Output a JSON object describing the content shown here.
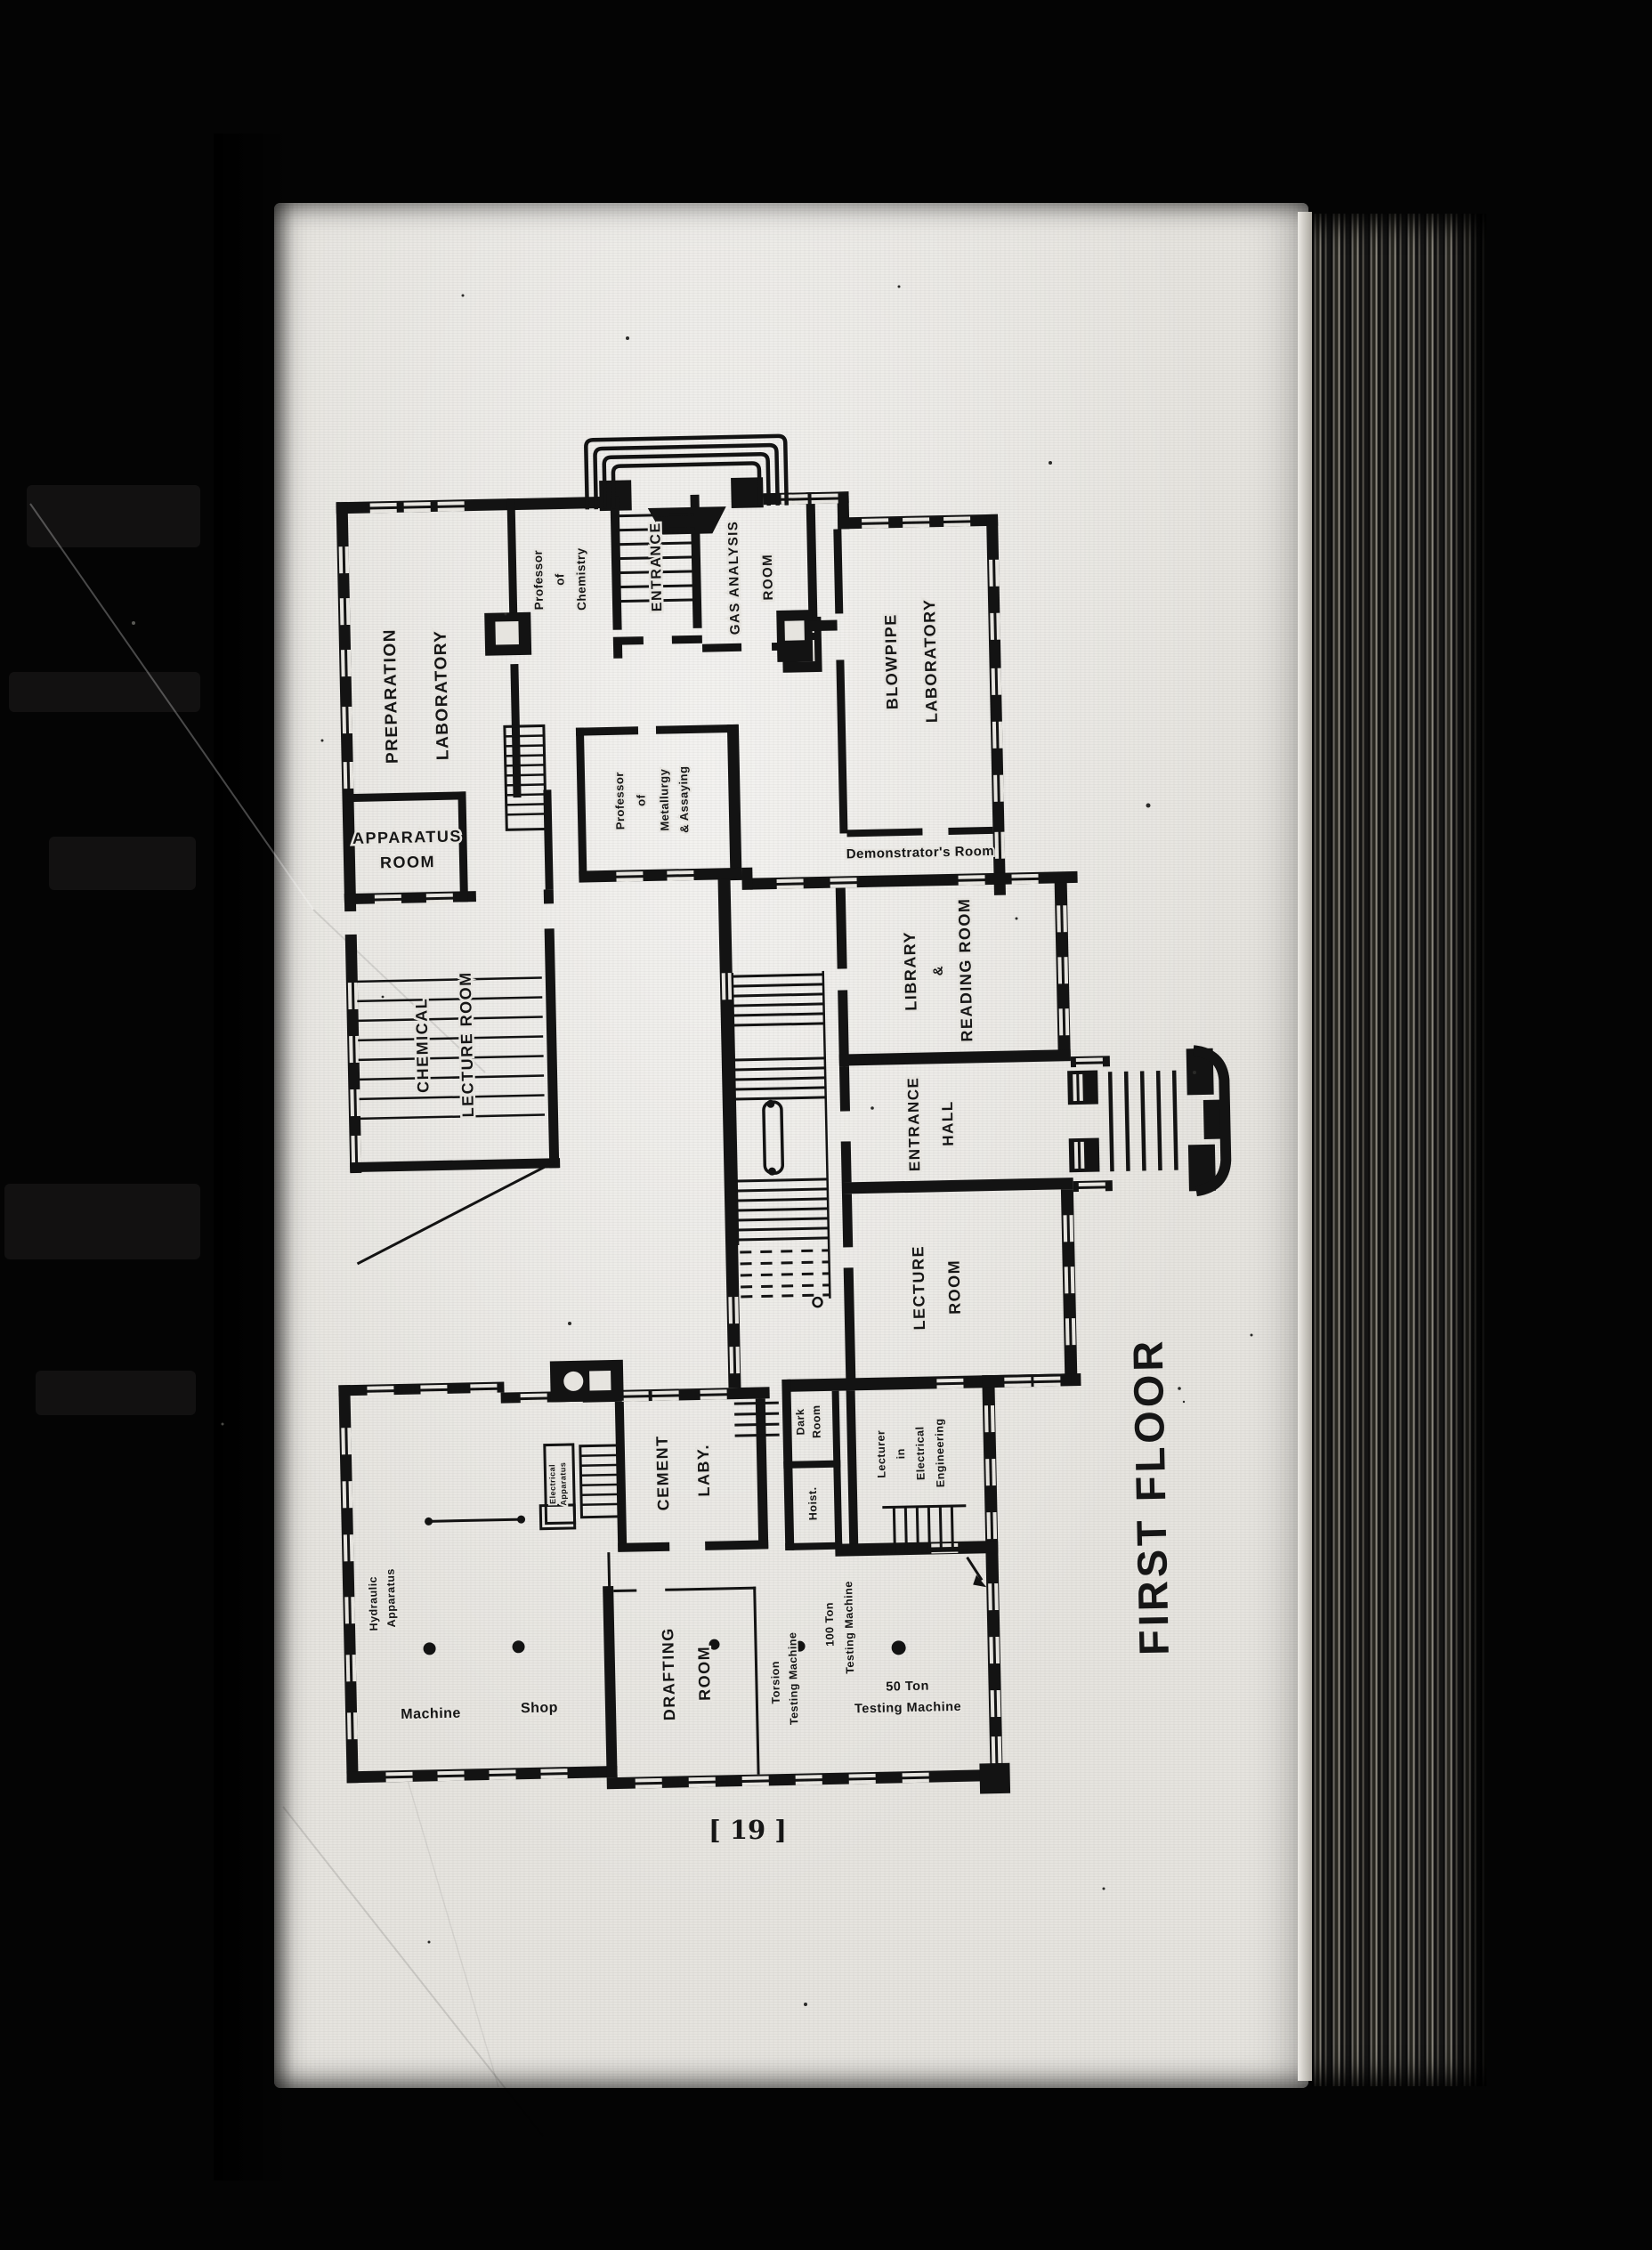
{
  "page": {
    "number": "[ 19 ]",
    "title": "FIRST FLOOR"
  },
  "colors": {
    "paper": "#e6e4df",
    "ink": "#131313",
    "background": "#040404"
  },
  "plan": {
    "rooms": {
      "preparation_laboratory": {
        "line1": "PREPARATION",
        "line2": "LABORATORY"
      },
      "apparatus_room": {
        "line1": "APPARATUS",
        "line2": "ROOM"
      },
      "professor_of_chemistry": {
        "line1": "Professor",
        "line2": "of",
        "line3": "Chemistry"
      },
      "entrance_stair": {
        "label": "ENTRANCE"
      },
      "gas_analysis_room": {
        "line1": "GAS ANALYSIS",
        "line2": "ROOM"
      },
      "blowpipe_laboratory": {
        "line1": "BLOWPIPE",
        "line2": "LABORATORY"
      },
      "demonstrators_room": {
        "label": "Demonstrator's Room"
      },
      "professor_of_metallurgy": {
        "line1": "Professor",
        "line2": "of",
        "line3": "Metallurgy",
        "line4": "& Assaying"
      },
      "chemical_lecture_room": {
        "line1": "CHEMICAL",
        "line2": "LECTURE ROOM"
      },
      "library_reading_room": {
        "line1": "LIBRARY",
        "line2": "&",
        "line3": "READING ROOM"
      },
      "entrance_hall": {
        "line1": "ENTRANCE",
        "line2": "HALL"
      },
      "lecture_room": {
        "line1": "LECTURE",
        "line2": "ROOM"
      },
      "dark_room": {
        "line1": "Dark",
        "line2": "Room"
      },
      "hoist": {
        "label": "Hoist."
      },
      "lecturer_electrical_engineering": {
        "line1": "Lecturer",
        "line2": "in",
        "line3": "Electrical",
        "line4": "Engineering"
      },
      "cement_laboratory": {
        "line1": "CEMENT",
        "line2": "LABY."
      },
      "electrical_apparatus": {
        "line1": "Electrical",
        "line2": "Apparatus"
      },
      "hydraulic_apparatus": {
        "line1": "Hydraulic",
        "line2": "Apparatus"
      },
      "machine_shop": {
        "line1": "Machine",
        "line2": "Shop"
      },
      "drafting_room": {
        "line1": "DRAFTING",
        "line2": "ROOM"
      },
      "torsion_testing_machine": {
        "line1": "Torsion",
        "line2": "Testing Machine"
      },
      "testing_machine_100_ton": {
        "line1": "100 Ton",
        "line2": "Testing Machine"
      },
      "testing_machine_50_ton": {
        "line1": "50 Ton",
        "line2": "Testing Machine"
      }
    }
  }
}
